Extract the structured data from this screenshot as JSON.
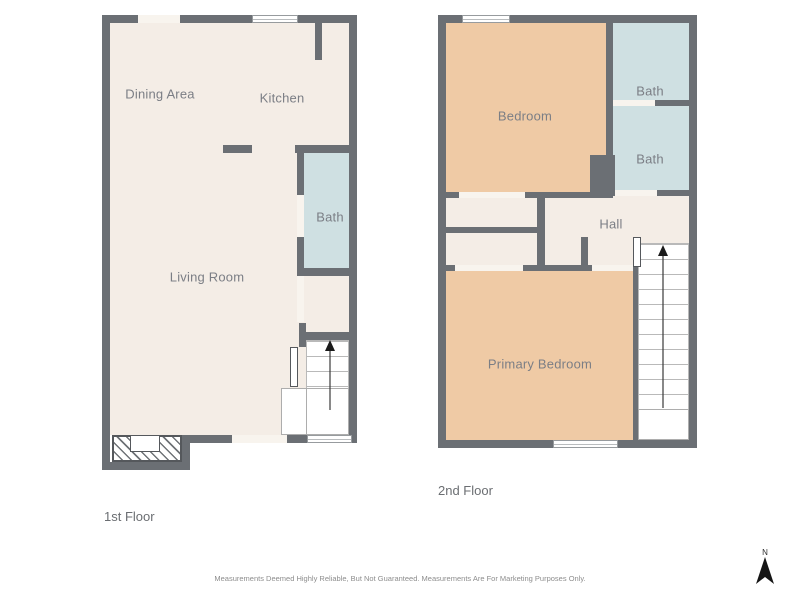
{
  "colors": {
    "wall": "#6b6f74",
    "floor": "#f4ede6",
    "bath": "#cfe0e2",
    "bedroom": "#efcaa5",
    "opening": "#f8f4ee",
    "label": "#7b7e85"
  },
  "floor1": {
    "label": "1st Floor",
    "rooms": {
      "dining": "Dining Area",
      "kitchen": "Kitchen",
      "bath": "Bath",
      "living": "Living Room"
    }
  },
  "floor2": {
    "label": "2nd Floor",
    "rooms": {
      "bedroom": "Bedroom",
      "bath_upper": "Bath",
      "bath_lower": "Bath",
      "hall": "Hall",
      "primary": "Primary Bedroom"
    }
  },
  "footer": {
    "disclaimer": "Measurements Deemed Highly Reliable, But Not Guaranteed. Measurements Are For Marketing Purposes Only."
  },
  "compass": {
    "label": "N"
  }
}
